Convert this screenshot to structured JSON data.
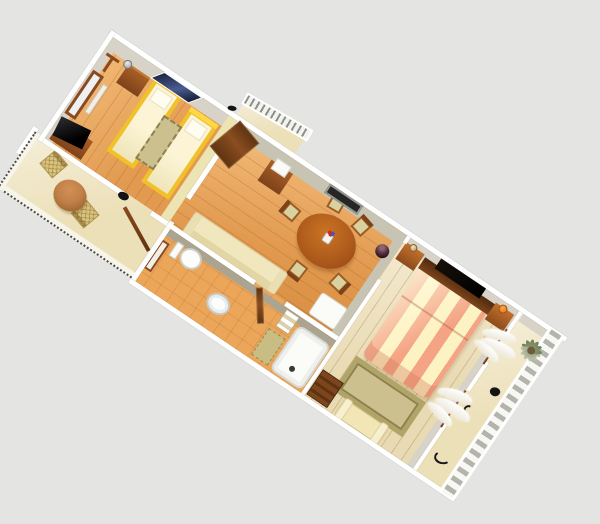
{
  "scene": {
    "description": "3D rendered floor plan of a long rectangular apartment viewed from above at an oblique angle on a plain gray background",
    "view": {
      "rotation_deg": 34,
      "style": "isometric-3d-render",
      "no_text_labels": true
    },
    "rooms": [
      {
        "name": "twin-bedroom",
        "furniture": [
          "coat-rack",
          "wardrobe-with-mirror",
          "towel-rack",
          "tv-on-stand",
          "dresser",
          "silver-table-lamp",
          "twin-bed",
          "twin-bed",
          "olive-rug",
          "navy-wall-window"
        ]
      },
      {
        "name": "living-dining-room",
        "furniture": [
          "entrance-door-open",
          "cabinet",
          "white-box",
          "oval-dining-table",
          "flower-vase",
          "dining-chair",
          "dining-chair",
          "dining-chair",
          "dining-chair",
          "dining-chair",
          "cream-sofa",
          "dark-sphere-vase",
          "dark-wall-window",
          "white-side-table"
        ]
      },
      {
        "name": "bathroom",
        "furniture": [
          "framed-wall-mirror",
          "toilet",
          "washbasin",
          "towel-shelf",
          "bathtub",
          "olive-bath-mat",
          "door-open"
        ]
      },
      {
        "name": "double-bedroom",
        "furniture": [
          "wall-tv-panel",
          "dark-headboard",
          "striped-double-bed",
          "nightstand",
          "nightstand",
          "orange-lamp",
          "bordered-rug",
          "storage-chest",
          "cream-bench",
          "white-curtains"
        ]
      },
      {
        "name": "balcony-left",
        "furniture": [
          "wicker-chair",
          "wicker-chair",
          "round-copper-table",
          "dotted-railing",
          "folded-lounger",
          "small-dark-bird"
        ]
      },
      {
        "name": "balcony-right",
        "furniture": [
          "palm-plant",
          "ladder-style-railing",
          "wrought-iron-decor",
          "wrought-iron-decor",
          "dark-blob"
        ]
      },
      {
        "name": "entrance-porch",
        "furniture": [
          "baluster-railing",
          "door-handle"
        ]
      }
    ]
  },
  "palette": {
    "bg": "#e4e4e2",
    "wall-white": "#ffffff",
    "wall-face-gray": "#d7d3c8",
    "wall-face-yellow": "#ece4b2",
    "wall-face-olive": "#aba490",
    "wood-orange": "#e29a50",
    "wood-orange-light": "#f2bb78",
    "tile-orange": "#eca65a",
    "wood-pale": "#e8dab2",
    "sand": "#ece0b8",
    "bed-yellow": "#f0c228",
    "cream": "#fcf4d4",
    "salmon": "#f4a484",
    "stripe-cream": "#fdf2c2",
    "table-brown": "#b05f1b",
    "dark-brown": "#63330f",
    "rug-olive": "#ccc18e",
    "seat-tan": "#d9d2a0",
    "wicker-tan": "#d9c37e",
    "navy-window": "#23304f",
    "copper": "#c08048",
    "palm-green": "#8d9a74",
    "lamp-orange": "#e07818"
  }
}
